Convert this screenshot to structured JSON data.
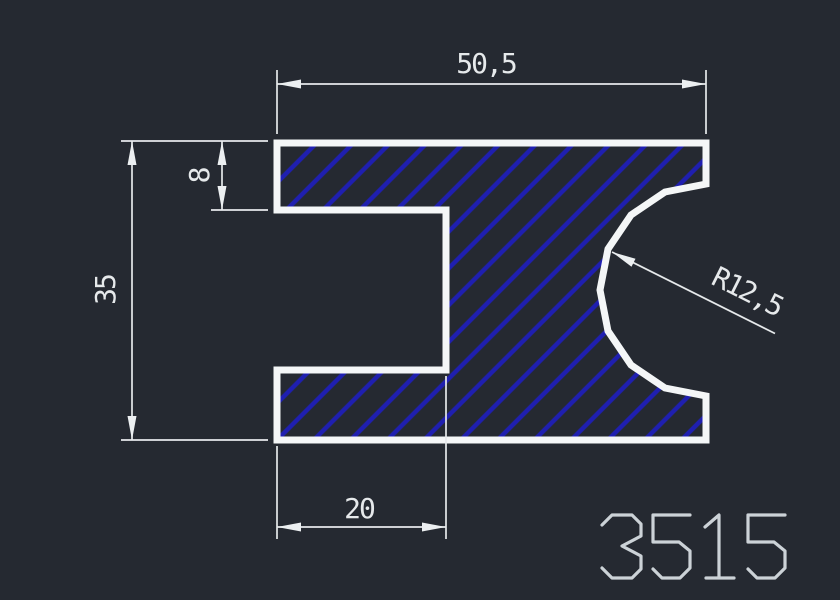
{
  "drawing": {
    "part_number": "3515",
    "dimensions": {
      "overall_width": "50,5",
      "overall_height": "35",
      "flange_thickness": "8",
      "slot_depth": "20",
      "notch_radius": "R12,5"
    },
    "colors": {
      "background": "#252931",
      "profile_outline": "#f4f6f7",
      "hatch_blue": "#1f1fb0",
      "dimension_lines": "#e6e9eb",
      "part_number_text": "#ccd2d7"
    }
  }
}
